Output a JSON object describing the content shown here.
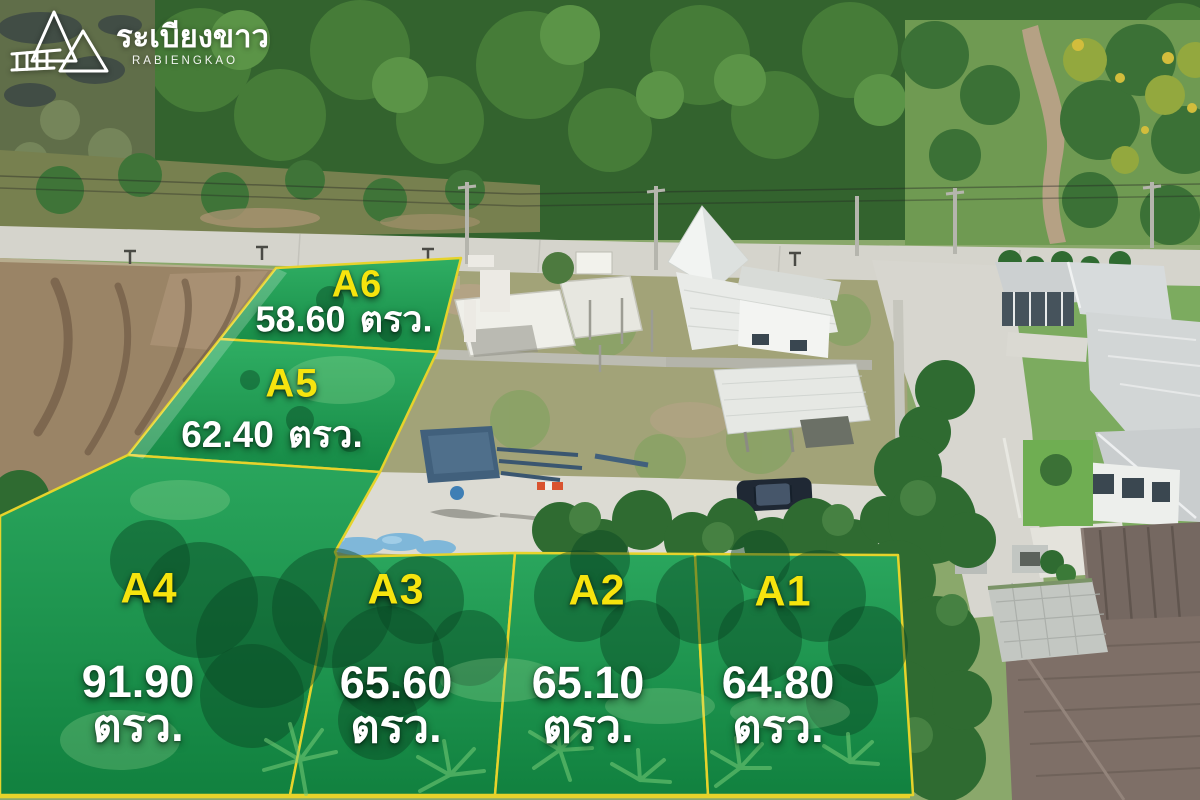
{
  "logo": {
    "brand_thai": "ระเบียงขาว",
    "brand_latin": "RABIENGKAO"
  },
  "plots": [
    {
      "id": "A1",
      "area": "64.80",
      "unit": "ตรว."
    },
    {
      "id": "A2",
      "area": "65.10",
      "unit": "ตรว."
    },
    {
      "id": "A3",
      "area": "65.60",
      "unit": "ตรว."
    },
    {
      "id": "A4",
      "area": "91.90",
      "unit": "ตรว."
    },
    {
      "id": "A5",
      "area": "62.40",
      "unit": "ตรว."
    },
    {
      "id": "A6",
      "area": "58.60",
      "unit": "ตรว."
    }
  ],
  "colors": {
    "plot_overlay_green": "#1b9a52",
    "plot_border_yellow": "#e6d32b",
    "plot_id_yellow": "#f6e40e",
    "area_text_white": "#ffffff"
  }
}
